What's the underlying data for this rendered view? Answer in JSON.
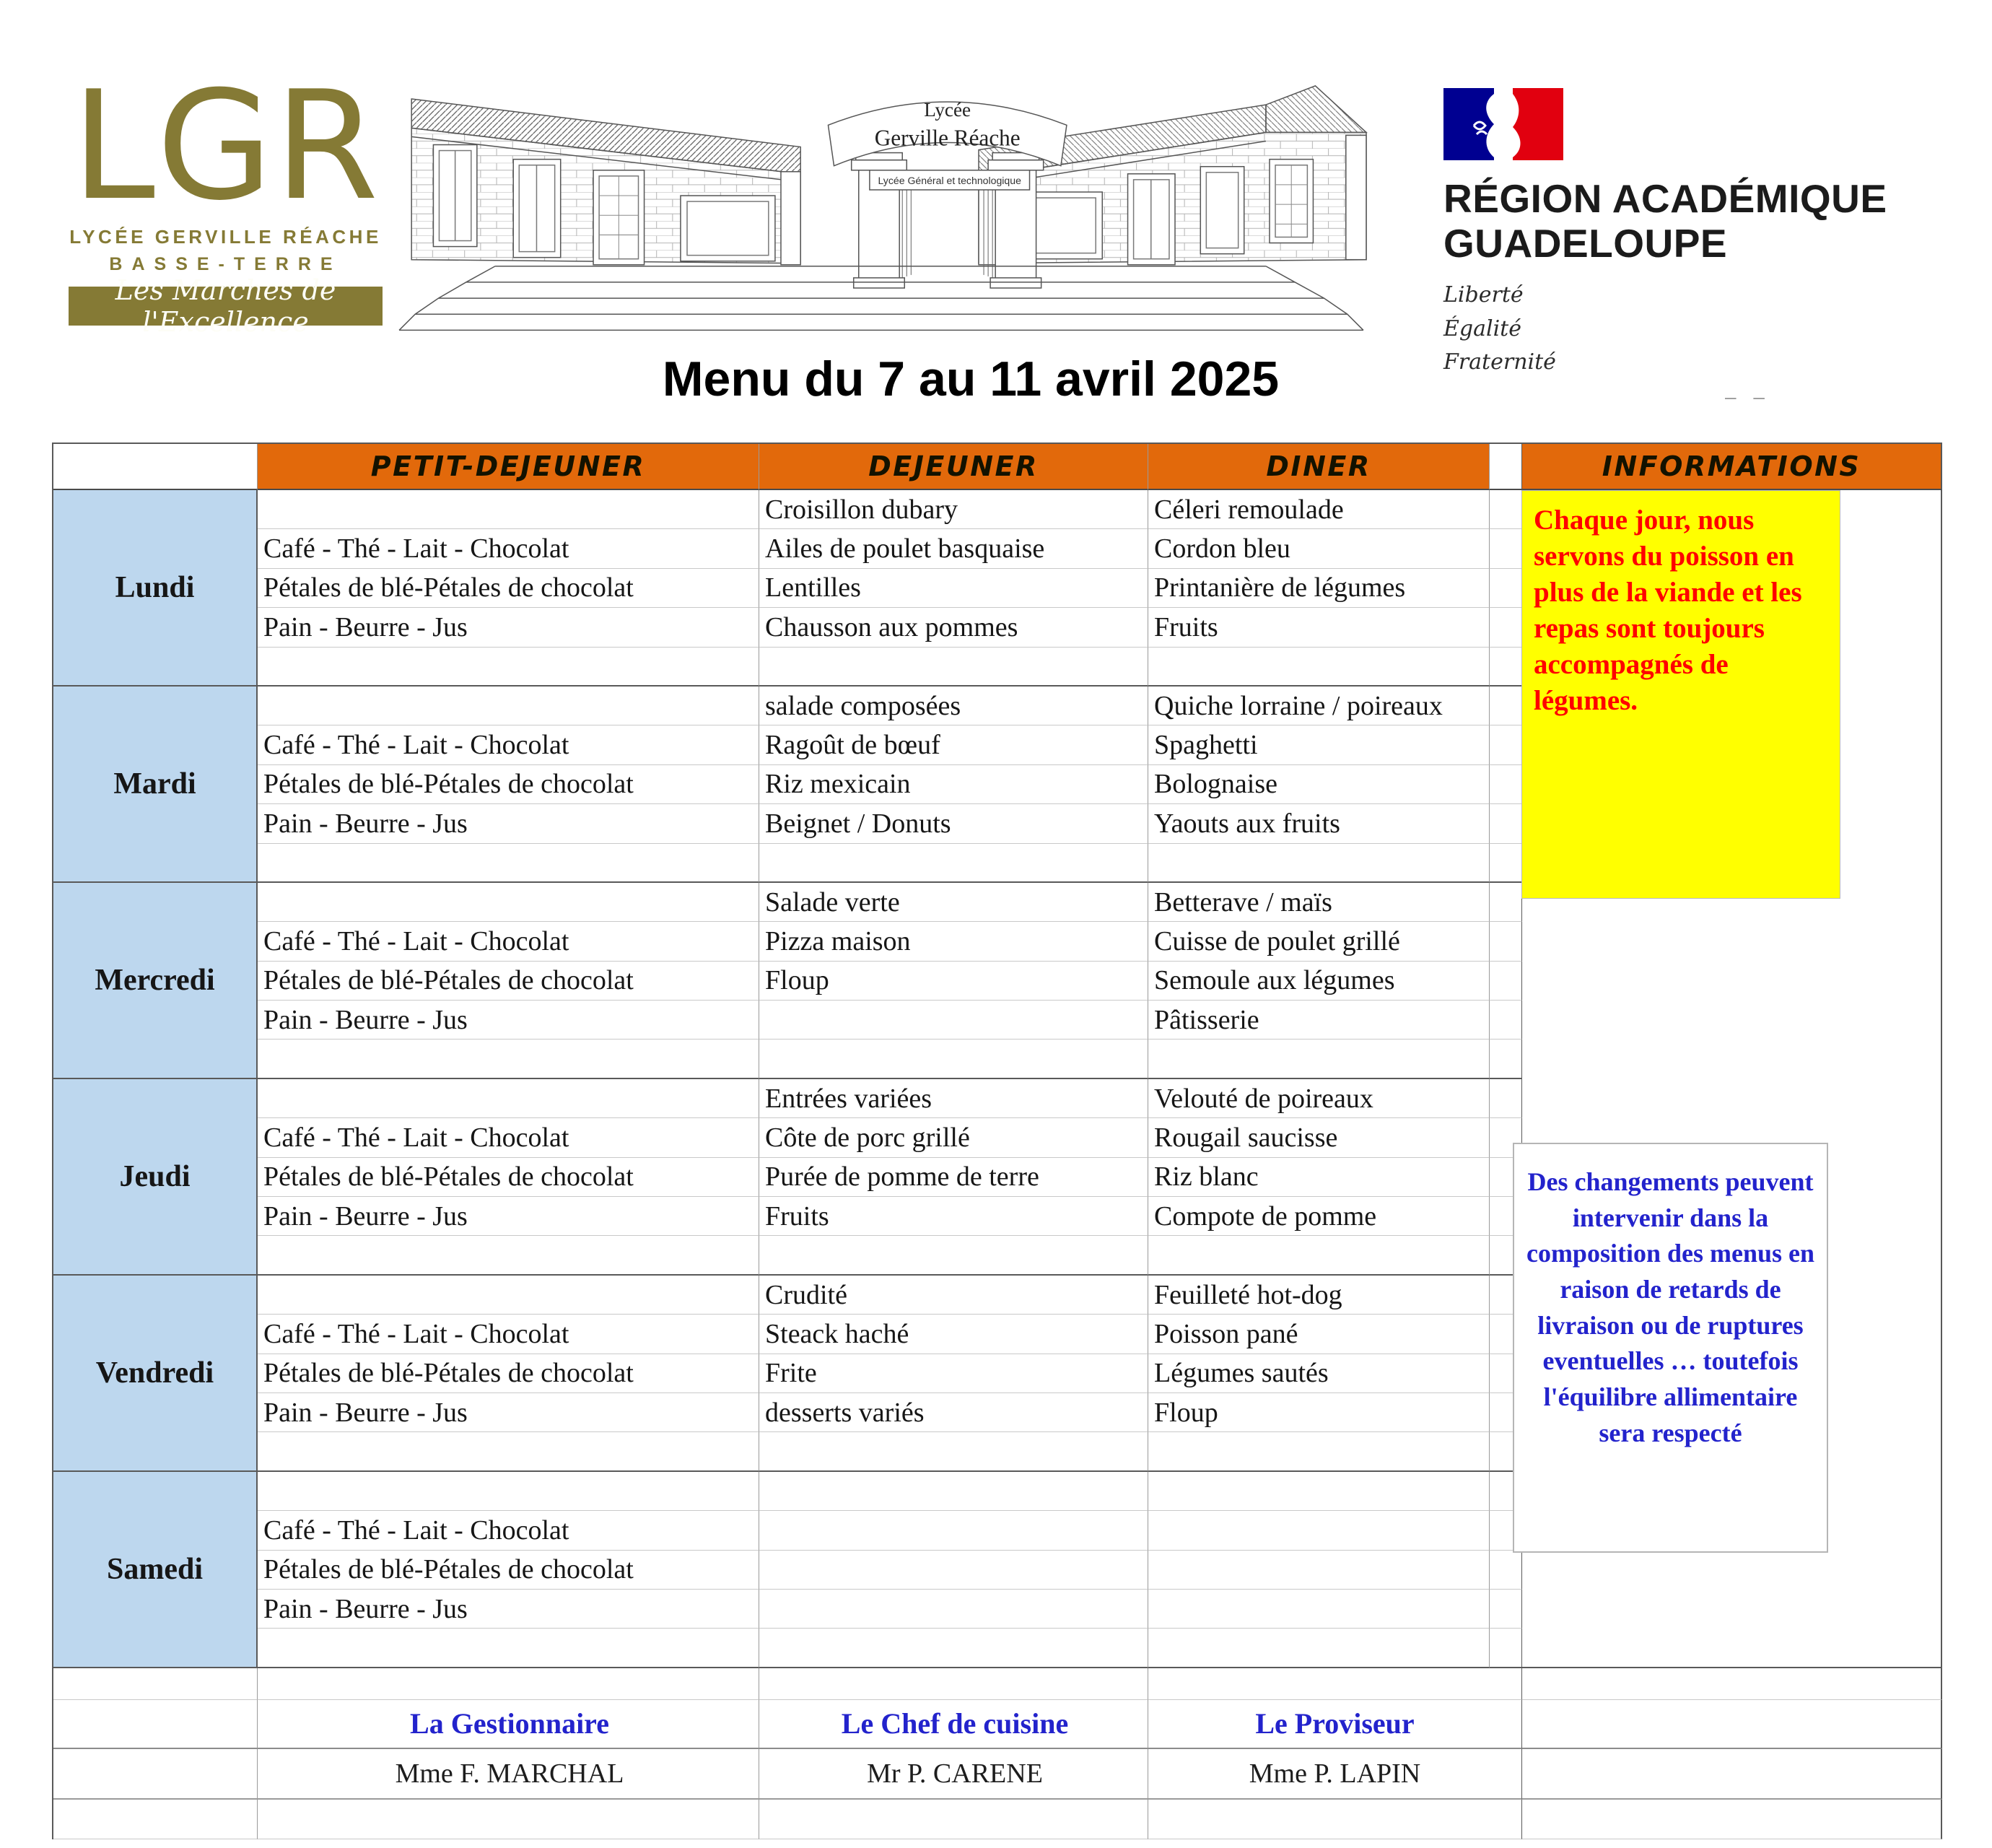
{
  "branding": {
    "lgr": {
      "acronym": "LGR",
      "school_line1": "LYCÉE GERVILLE RÉACHE",
      "school_line2": "BASSE-TERRE",
      "motto": "Les Marches de l'Excellence"
    },
    "building_sign": {
      "line1": "Lycée",
      "line2": "Gerville Réache",
      "subtitle": "Lycée Général et technologique"
    },
    "region": {
      "line1": "RÉGION ACADÉMIQUE",
      "line2": "GUADELOUPE",
      "devise1": "Liberté",
      "devise2": "Égalité",
      "devise3": "Fraternité"
    }
  },
  "title": "Menu du 7 au 11 avril 2025",
  "misc": {
    "dashes": "– –"
  },
  "table": {
    "headers": {
      "petit_dejeuner": "PETIT-DEJEUNER",
      "dejeuner": "DEJEUNER",
      "diner": "DINER",
      "informations": "INFORMATIONS"
    },
    "days": [
      {
        "label": "Lundi",
        "petit_dejeuner": [
          "Café - Thé - Lait - Chocolat",
          "Pétales de blé-Pétales de chocolat",
          "Pain - Beurre - Jus"
        ],
        "dejeuner": [
          "Croisillon dubary",
          "Ailes de poulet basquaise",
          "Lentilles",
          "Chausson aux pommes"
        ],
        "diner": [
          "Céleri remoulade",
          "Cordon bleu",
          "Printanière de légumes",
          "Fruits"
        ]
      },
      {
        "label": "Mardi",
        "petit_dejeuner": [
          "Café - Thé - Lait - Chocolat",
          "Pétales de blé-Pétales de chocolat",
          "Pain - Beurre - Jus"
        ],
        "dejeuner": [
          "salade composées",
          "Ragoût de bœuf",
          "Riz mexicain",
          "Beignet / Donuts"
        ],
        "diner": [
          "Quiche lorraine / poireaux",
          "Spaghetti",
          "Bolognaise",
          "Yaouts aux fruits"
        ]
      },
      {
        "label": "Mercredi",
        "petit_dejeuner": [
          "Café - Thé - Lait - Chocolat",
          "Pétales de blé-Pétales de chocolat",
          "Pain - Beurre - Jus"
        ],
        "dejeuner": [
          "Salade verte",
          "Pizza maison",
          "Floup",
          ""
        ],
        "diner": [
          "Betterave / maïs",
          "Cuisse de poulet grillé",
          "Semoule aux légumes",
          "Pâtisserie"
        ]
      },
      {
        "label": "Jeudi",
        "petit_dejeuner": [
          "Café - Thé - Lait - Chocolat",
          "Pétales de blé-Pétales de chocolat",
          "Pain - Beurre - Jus"
        ],
        "dejeuner": [
          "Entrées variées",
          "Côte de porc grillé",
          "Purée de pomme de terre",
          "Fruits"
        ],
        "diner": [
          "Velouté de poireaux",
          "Rougail saucisse",
          "Riz blanc",
          "Compote de pomme"
        ]
      },
      {
        "label": "Vendredi",
        "petit_dejeuner": [
          "Café - Thé - Lait - Chocolat",
          "Pétales de blé-Pétales de chocolat",
          "Pain - Beurre - Jus"
        ],
        "dejeuner": [
          "Crudité",
          "Steack haché",
          "Frite",
          "desserts variés"
        ],
        "diner": [
          "Feuilleté hot-dog",
          "Poisson pané",
          "Légumes sautés",
          "Floup"
        ]
      },
      {
        "label": "Samedi",
        "petit_dejeuner": [
          "Café - Thé - Lait - Chocolat",
          "Pétales de blé-Pétales de chocolat",
          "Pain - Beurre - Jus"
        ],
        "dejeuner": [
          "",
          "",
          "",
          ""
        ],
        "diner": [
          "",
          "",
          "",
          ""
        ]
      }
    ]
  },
  "notes": {
    "daily_fish": "Chaque jour, nous servons du poisson en plus de la viande et les repas sont toujours accompagnés de légumes.",
    "changes": "Des changements peuvent intervenir dans la composition des menus en raison de retards de livraison ou de ruptures eventuelles … toutefois l'équilibre allimentaire sera respecté"
  },
  "signatures": {
    "roles": [
      "La Gestionnaire",
      "Le Chef de cuisine",
      "Le Proviseur"
    ],
    "names": [
      "Mme F. MARCHAL",
      "Mr P. CARENE",
      "Mme P. LAPIN"
    ]
  },
  "colors": {
    "brand_olive": "#857a35",
    "header_orange": "#e2690b",
    "day_blue": "#bdd7ee",
    "note_yellow_bg": "#ffff00",
    "note_red_text": "#ff0000",
    "note_blue_text": "#2323cc",
    "flag_blue": "#000091",
    "flag_red": "#e1000f"
  }
}
